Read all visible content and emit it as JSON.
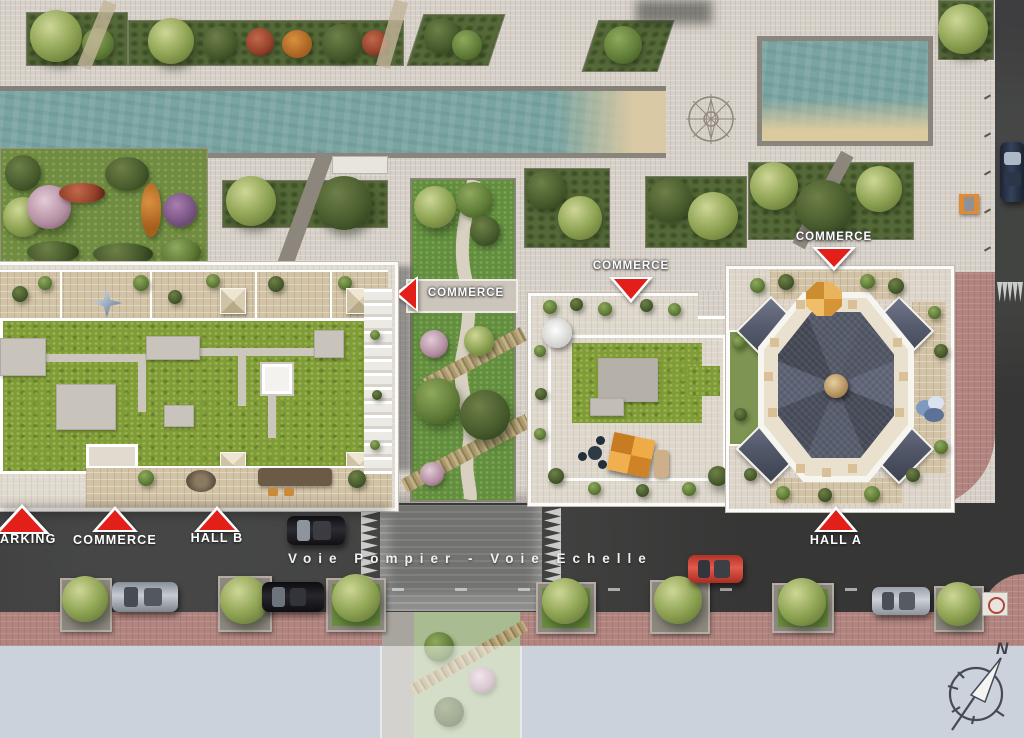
{
  "map": {
    "road": {
      "name": "Voie Pompier - Voie Echelle"
    },
    "markers": {
      "parking": {
        "label": "PARKING"
      },
      "commerce_bottom": {
        "label": "COMMERCE"
      },
      "hall_b": {
        "label": "HALL B"
      },
      "hall_a": {
        "label": "HALL A"
      },
      "commerce_garden": {
        "label": "COMMERCE"
      },
      "commerce_center": {
        "label": "COMMERCE"
      },
      "commerce_right": {
        "label": "COMMERCE"
      }
    },
    "compass": {
      "north": "N"
    }
  },
  "colors": {
    "marker_red": "#e31f1a",
    "water": "#79a4a1",
    "lawn": "#7f9c39",
    "asphalt": "#3e3d3f",
    "pink_sidewalk": "#b2847f",
    "pavement": "#d6d0c8",
    "void_gray": "#ccd2db",
    "roof_slate": "#4e5361"
  }
}
